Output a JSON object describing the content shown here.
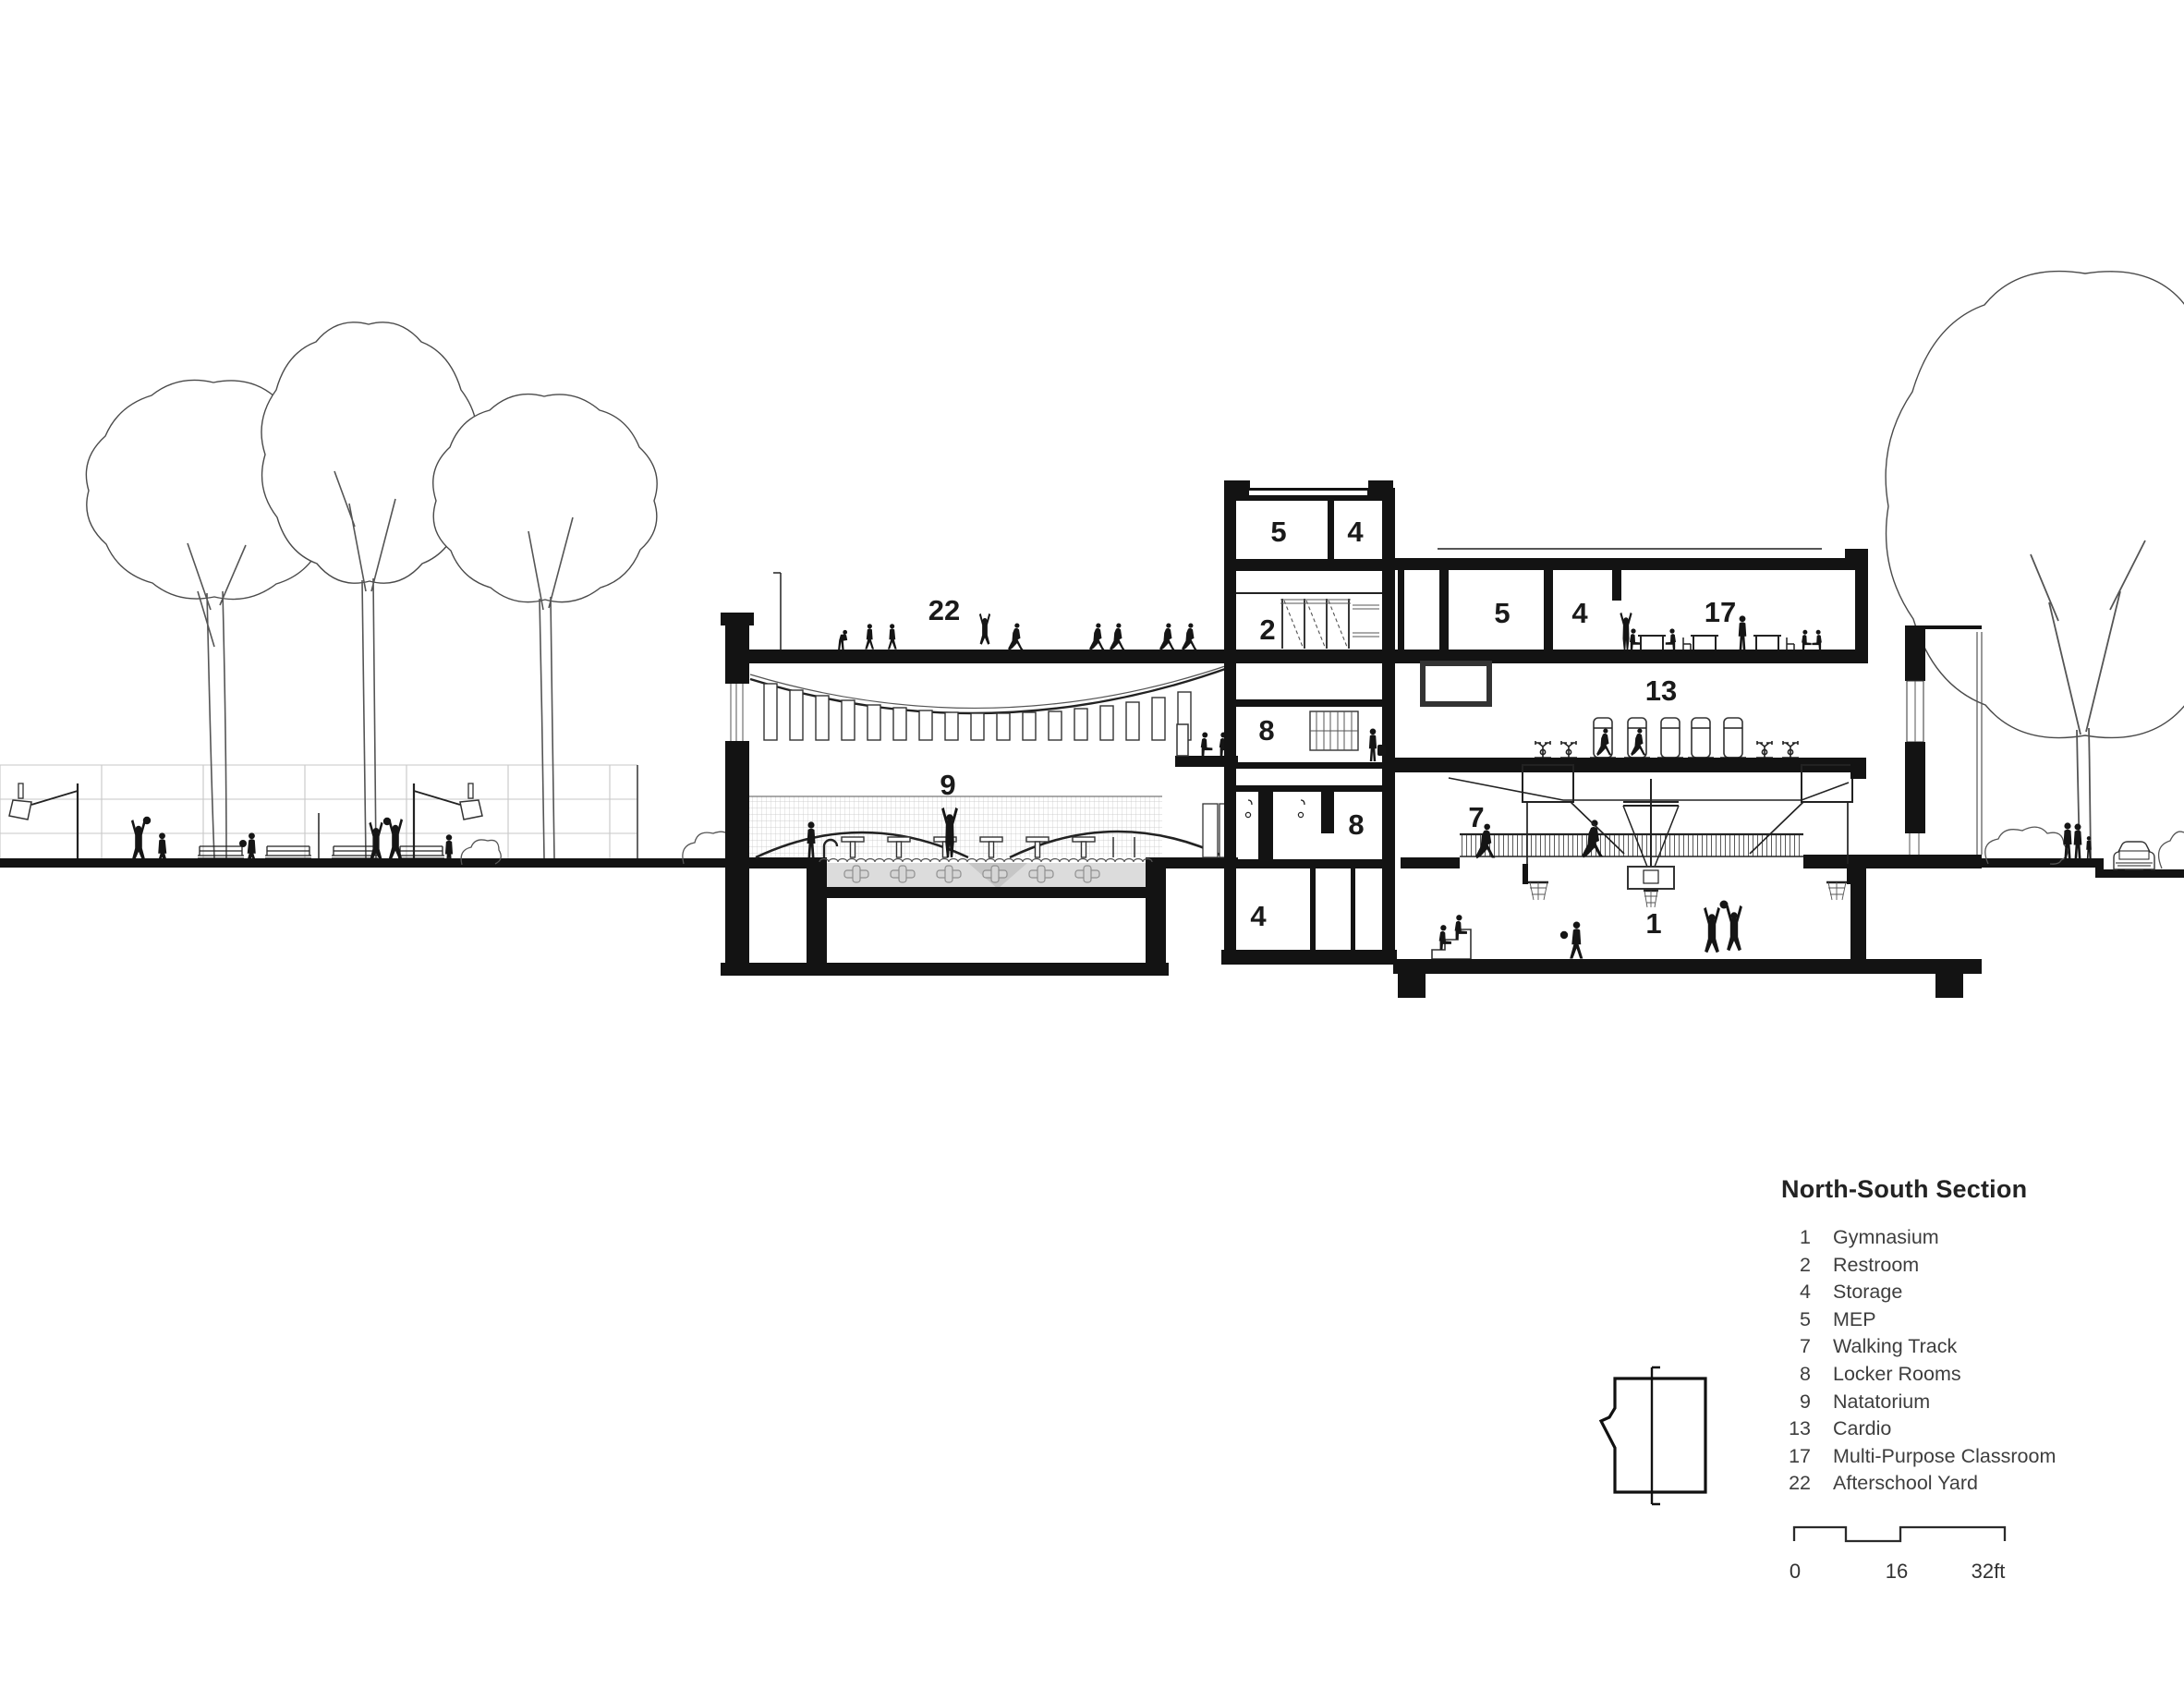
{
  "drawing": {
    "title": "North-South Section",
    "room_labels": {
      "gym": "1",
      "restroom": "2",
      "storage_basement": "4",
      "storage_penthouse": "4",
      "storage_upper": "4",
      "mep_penthouse": "5",
      "mep_upper": "5",
      "walking_track": "7",
      "lockers": "8",
      "lockers_lower": "8",
      "natatorium": "9",
      "cardio": "13",
      "classroom": "17",
      "yard": "22"
    }
  },
  "legend": {
    "title": "North-South Section",
    "items": [
      {
        "number": "1",
        "label": "Gymnasium"
      },
      {
        "number": "2",
        "label": "Restroom"
      },
      {
        "number": "4",
        "label": "Storage"
      },
      {
        "number": "5",
        "label": "MEP"
      },
      {
        "number": "7",
        "label": "Walking Track"
      },
      {
        "number": "8",
        "label": "Locker Rooms"
      },
      {
        "number": "9",
        "label": "Natatorium"
      },
      {
        "number": "13",
        "label": "Cardio"
      },
      {
        "number": "17",
        "label": "Multi-Purpose Classroom"
      },
      {
        "number": "22",
        "label": "Afterschool Yard"
      }
    ]
  },
  "scale_bar": {
    "start": "0",
    "mid": "16",
    "end": "32ft"
  }
}
